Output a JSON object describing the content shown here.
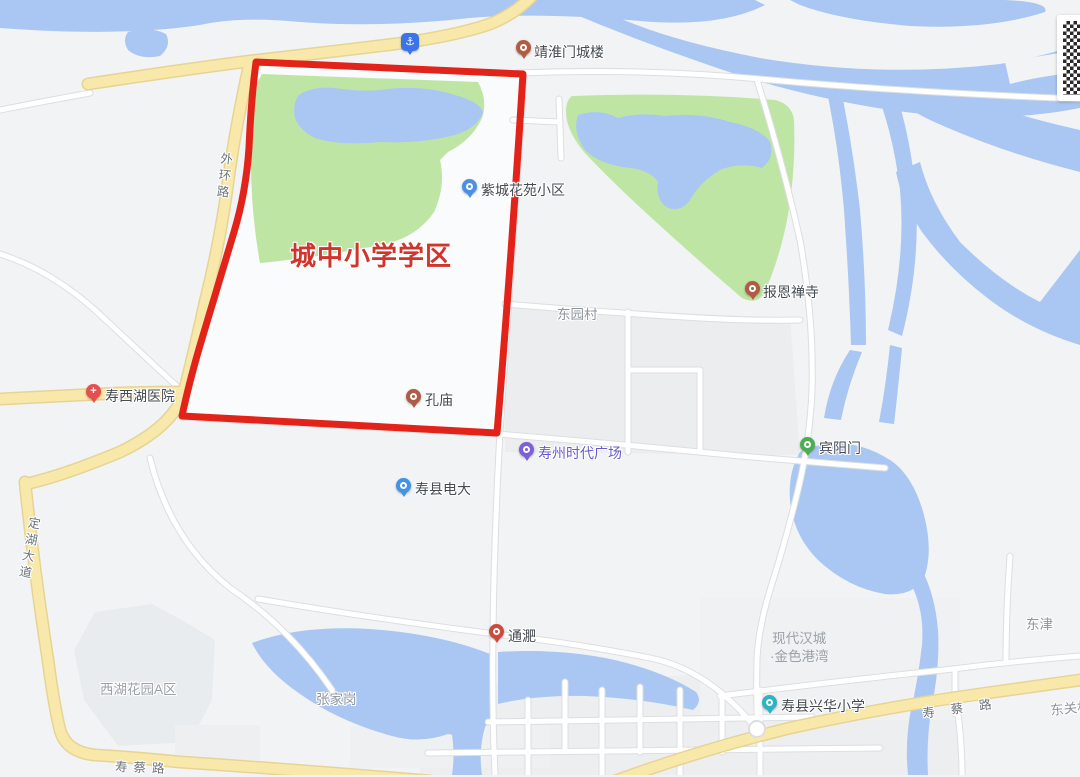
{
  "district_overlay": {
    "title": "城中小学学区",
    "boundary_color": "#e2231a",
    "title_color": "#d0342c"
  },
  "colors": {
    "water": "#a9c7f2",
    "park_green": "#bfe5a5",
    "road_yellow": "#f8e9aa",
    "road_yellow_casing": "#e7d494",
    "road_white": "#ffffff",
    "land_base": "#f1f3f4",
    "poi_text": "#454b52",
    "road_text": "#6d747b",
    "area_text": "#8e959d"
  },
  "pois": [
    {
      "label": "靖淮门城楼",
      "pin_color": "#b05c44",
      "icon": "tower-pin"
    },
    {
      "label": "紫城花苑小区",
      "pin_color": "#4a90e8",
      "icon": "community-pin"
    },
    {
      "label": "报恩禅寺",
      "pin_color": "#b05c44",
      "icon": "temple-pin"
    },
    {
      "label": "寿西湖医院",
      "pin_color": "#e4504e",
      "icon": "hospital-cross-pin"
    },
    {
      "label": "孔庙",
      "pin_color": "#b05c44",
      "icon": "temple-pin"
    },
    {
      "label": "寿州时代广场",
      "pin_color": "#7e5fd8",
      "label_color": "#6b58cf",
      "icon": "mall-pin"
    },
    {
      "label": "寿县电大",
      "pin_color": "#4293e6",
      "icon": "school-pin"
    },
    {
      "label": "宾阳门",
      "pin_color": "#4bae50",
      "icon": "scenic-pin"
    },
    {
      "label": "通淝",
      "pin_color": "#cc4b3e",
      "icon": "landmark-pin"
    },
    {
      "label": "寿县兴华小学",
      "pin_color": "#2bb3c6",
      "icon": "school-pin"
    }
  ],
  "map_icons": {
    "anchor": "⚓"
  },
  "road_labels": [
    {
      "label": "外环路",
      "orientation": "vertical"
    },
    {
      "label": "定湖大道",
      "orientation": "vertical"
    },
    {
      "label": "寿蔡路",
      "orientation": "horizontal"
    },
    {
      "label": "寿蔡路",
      "orientation": "horizontal"
    }
  ],
  "area_labels": [
    {
      "label": "东园村"
    },
    {
      "label": "张家岗"
    },
    {
      "label": "东津"
    },
    {
      "label": "西湖花园A区"
    },
    {
      "lines": [
        "现代汉城",
        "·金色港湾"
      ]
    },
    {
      "label": "东关村"
    }
  ]
}
